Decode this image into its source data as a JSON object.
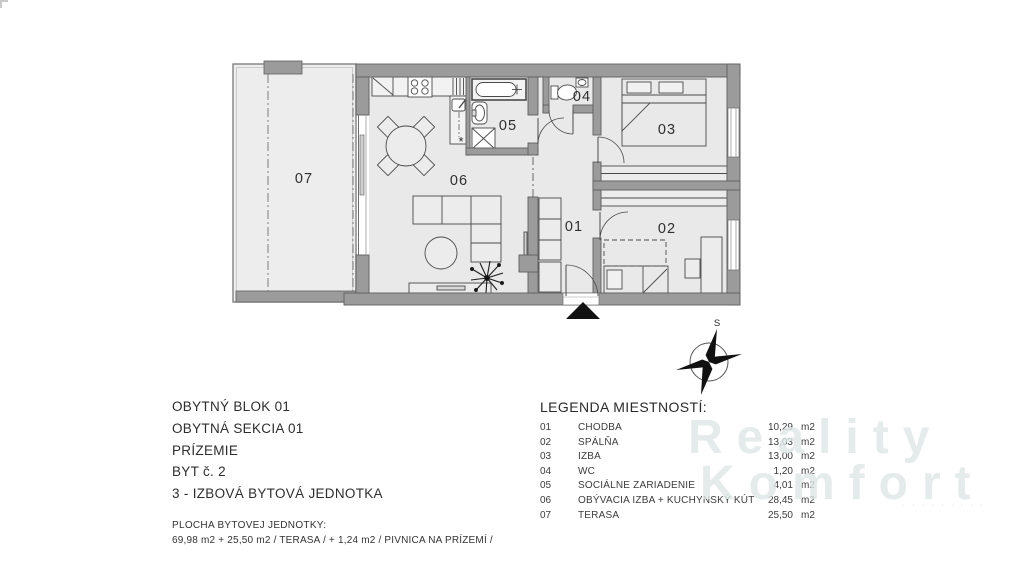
{
  "info_block": {
    "lines": [
      "OBYTNÝ BLOK 01",
      "OBYTNÁ SEKCIA 01",
      "PRÍZEMIE",
      "BYT č. 2",
      "3 - IZBOVÁ BYTOVÁ JEDNOTKA"
    ],
    "area_label": "PLOCHA BYTOVEJ JEDNOTKY:",
    "area_value": "69,98 m2 + 25,50 m2 / TERASA / + 1,24 m2 / PIVNICA NA PRÍZEMÍ /"
  },
  "legend": {
    "title": "LEGENDA MIESTNOSTÍ:",
    "rows": [
      {
        "num": "01",
        "name": "CHODBA",
        "area": "10,29",
        "unit": "m2"
      },
      {
        "num": "02",
        "name": "SPÁLŇA",
        "area": "13,03",
        "unit": "m2"
      },
      {
        "num": "03",
        "name": "IZBA",
        "area": "13,00",
        "unit": "m2"
      },
      {
        "num": "04",
        "name": "WC",
        "area": "1,20",
        "unit": "m2"
      },
      {
        "num": "05",
        "name": "SOCIÁLNE ZARIADENIE",
        "area": "4,01",
        "unit": "m2"
      },
      {
        "num": "06",
        "name": "OBÝVACIA IZBA + KUCHYNSKÝ KÚT",
        "area": "28,45",
        "unit": "m2"
      },
      {
        "num": "07",
        "name": "TERASA",
        "area": "25,50",
        "unit": "m2"
      }
    ]
  },
  "plan": {
    "room_labels": {
      "r01": "01",
      "r02": "02",
      "r03": "03",
      "r04": "04",
      "r05": "05",
      "r06": "06",
      "r07": "07"
    },
    "kitchen_asterisk": "*",
    "compass_north": "S"
  },
  "watermark": {
    "line1": "Reality",
    "line2": "Komfort",
    "tagline": "· · · · · · · · ·"
  },
  "colors": {
    "wall": "#9b9b9b",
    "floor": "#e9e9e9",
    "terrace": "#ededed",
    "line": "#4a4a4a",
    "watermark": "#e2e5e5"
  }
}
